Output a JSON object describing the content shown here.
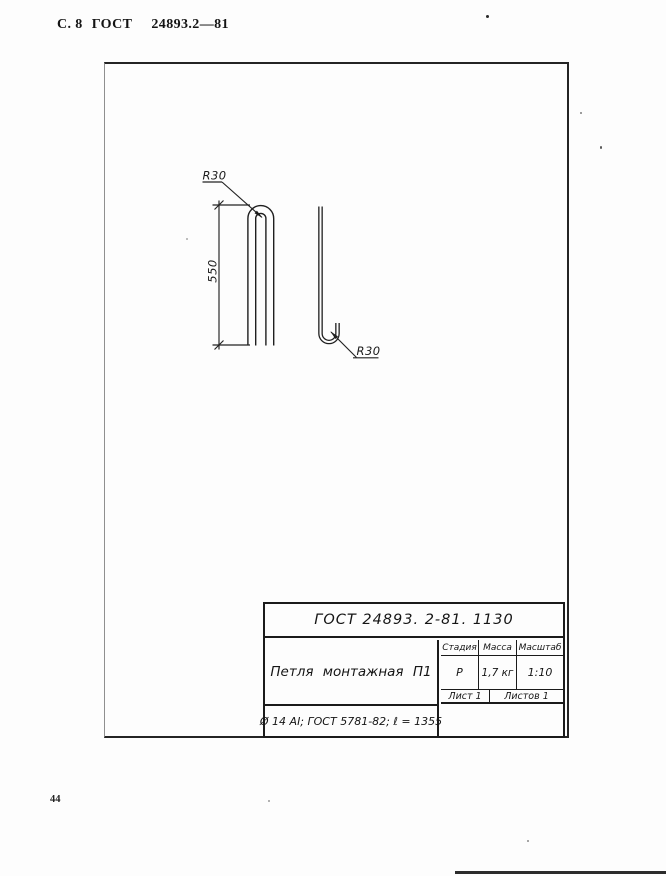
{
  "page": {
    "header": {
      "page_label": "С. 8",
      "doc_label": "ГОСТ",
      "doc_number": "24893.2—81"
    },
    "page_number": "44"
  },
  "drawing": {
    "annotations": {
      "radius_top": "R30",
      "height_dim": "550",
      "radius_bottom": "R30"
    }
  },
  "stamp": {
    "doc_ref": "ГОСТ 24893. 2-81. 1130",
    "part_name": "Петля монтажная П1",
    "spec_line": "Ø 14 АI;  ГОСТ 5781-82;  ℓ = 1355",
    "cols": {
      "stage_label": "Стадия",
      "mass_label": "Масса",
      "scale_label": "Масштаб"
    },
    "vals": {
      "stage": "Р",
      "mass": "1,7 кг",
      "scale": "1:10"
    },
    "sheet": {
      "sheet_label": "Лист 1",
      "sheets_label": "Листов 1"
    }
  },
  "colors": {
    "ink": "#1c1c1c",
    "paper": "#fdfdfd"
  }
}
